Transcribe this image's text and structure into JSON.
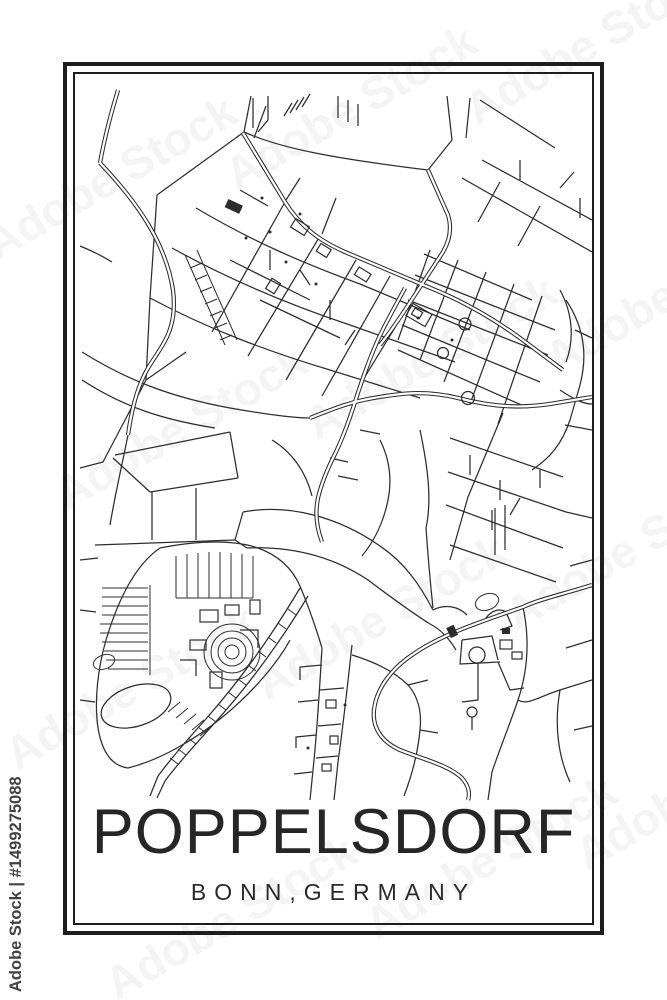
{
  "poster": {
    "title": "POPPELSDORF",
    "subtitle": "BONN,GERMANY"
  },
  "watermarks": {
    "stock_label": "Adobe Stock",
    "stock_id_label": "Adobe Stock | #1499275088"
  },
  "colors": {
    "map_line": "#2d2d2d",
    "frame": "#1d1d1d",
    "background": "#ffffff",
    "title_text": "#262626"
  }
}
